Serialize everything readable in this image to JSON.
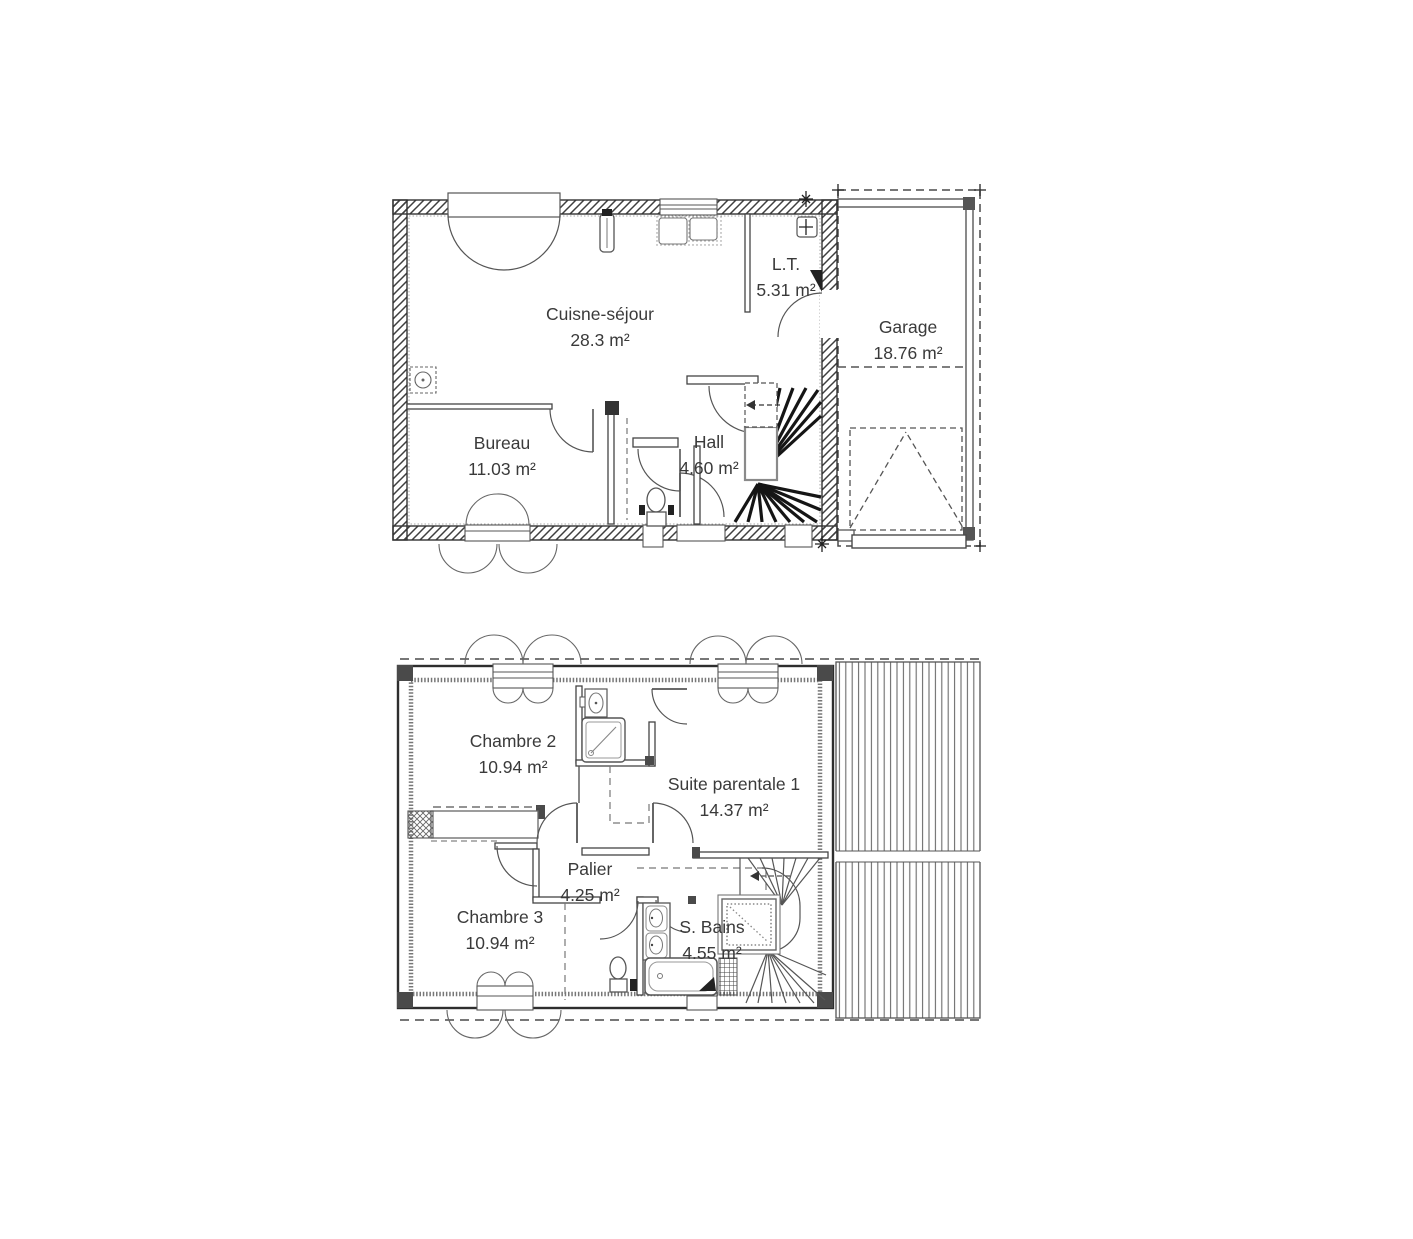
{
  "colors": {
    "ink": "#3a3a3a",
    "wall": "#3f3f3f",
    "background": "#ffffff"
  },
  "floors": [
    {
      "id": "ground-floor",
      "rooms": [
        {
          "label": "Cuisne-séjour",
          "area": "28.3 m²"
        },
        {
          "label": "L.T.",
          "area": "5.31 m²"
        },
        {
          "label": "Garage",
          "area": "18.76 m²"
        },
        {
          "label": "Bureau",
          "area": "11.03 m²"
        },
        {
          "label": "Hall",
          "area": "4.60 m²"
        }
      ]
    },
    {
      "id": "first-floor",
      "rooms": [
        {
          "label": "Chambre 2",
          "area": "10.94 m²"
        },
        {
          "label": "Suite parentale 1",
          "area": "14.37 m²"
        },
        {
          "label": "Palier",
          "area": "4.25 m²"
        },
        {
          "label": "Chambre 3",
          "area": "10.94 m²"
        },
        {
          "label": "S. Bains",
          "area": "4.55 m²"
        }
      ]
    }
  ]
}
